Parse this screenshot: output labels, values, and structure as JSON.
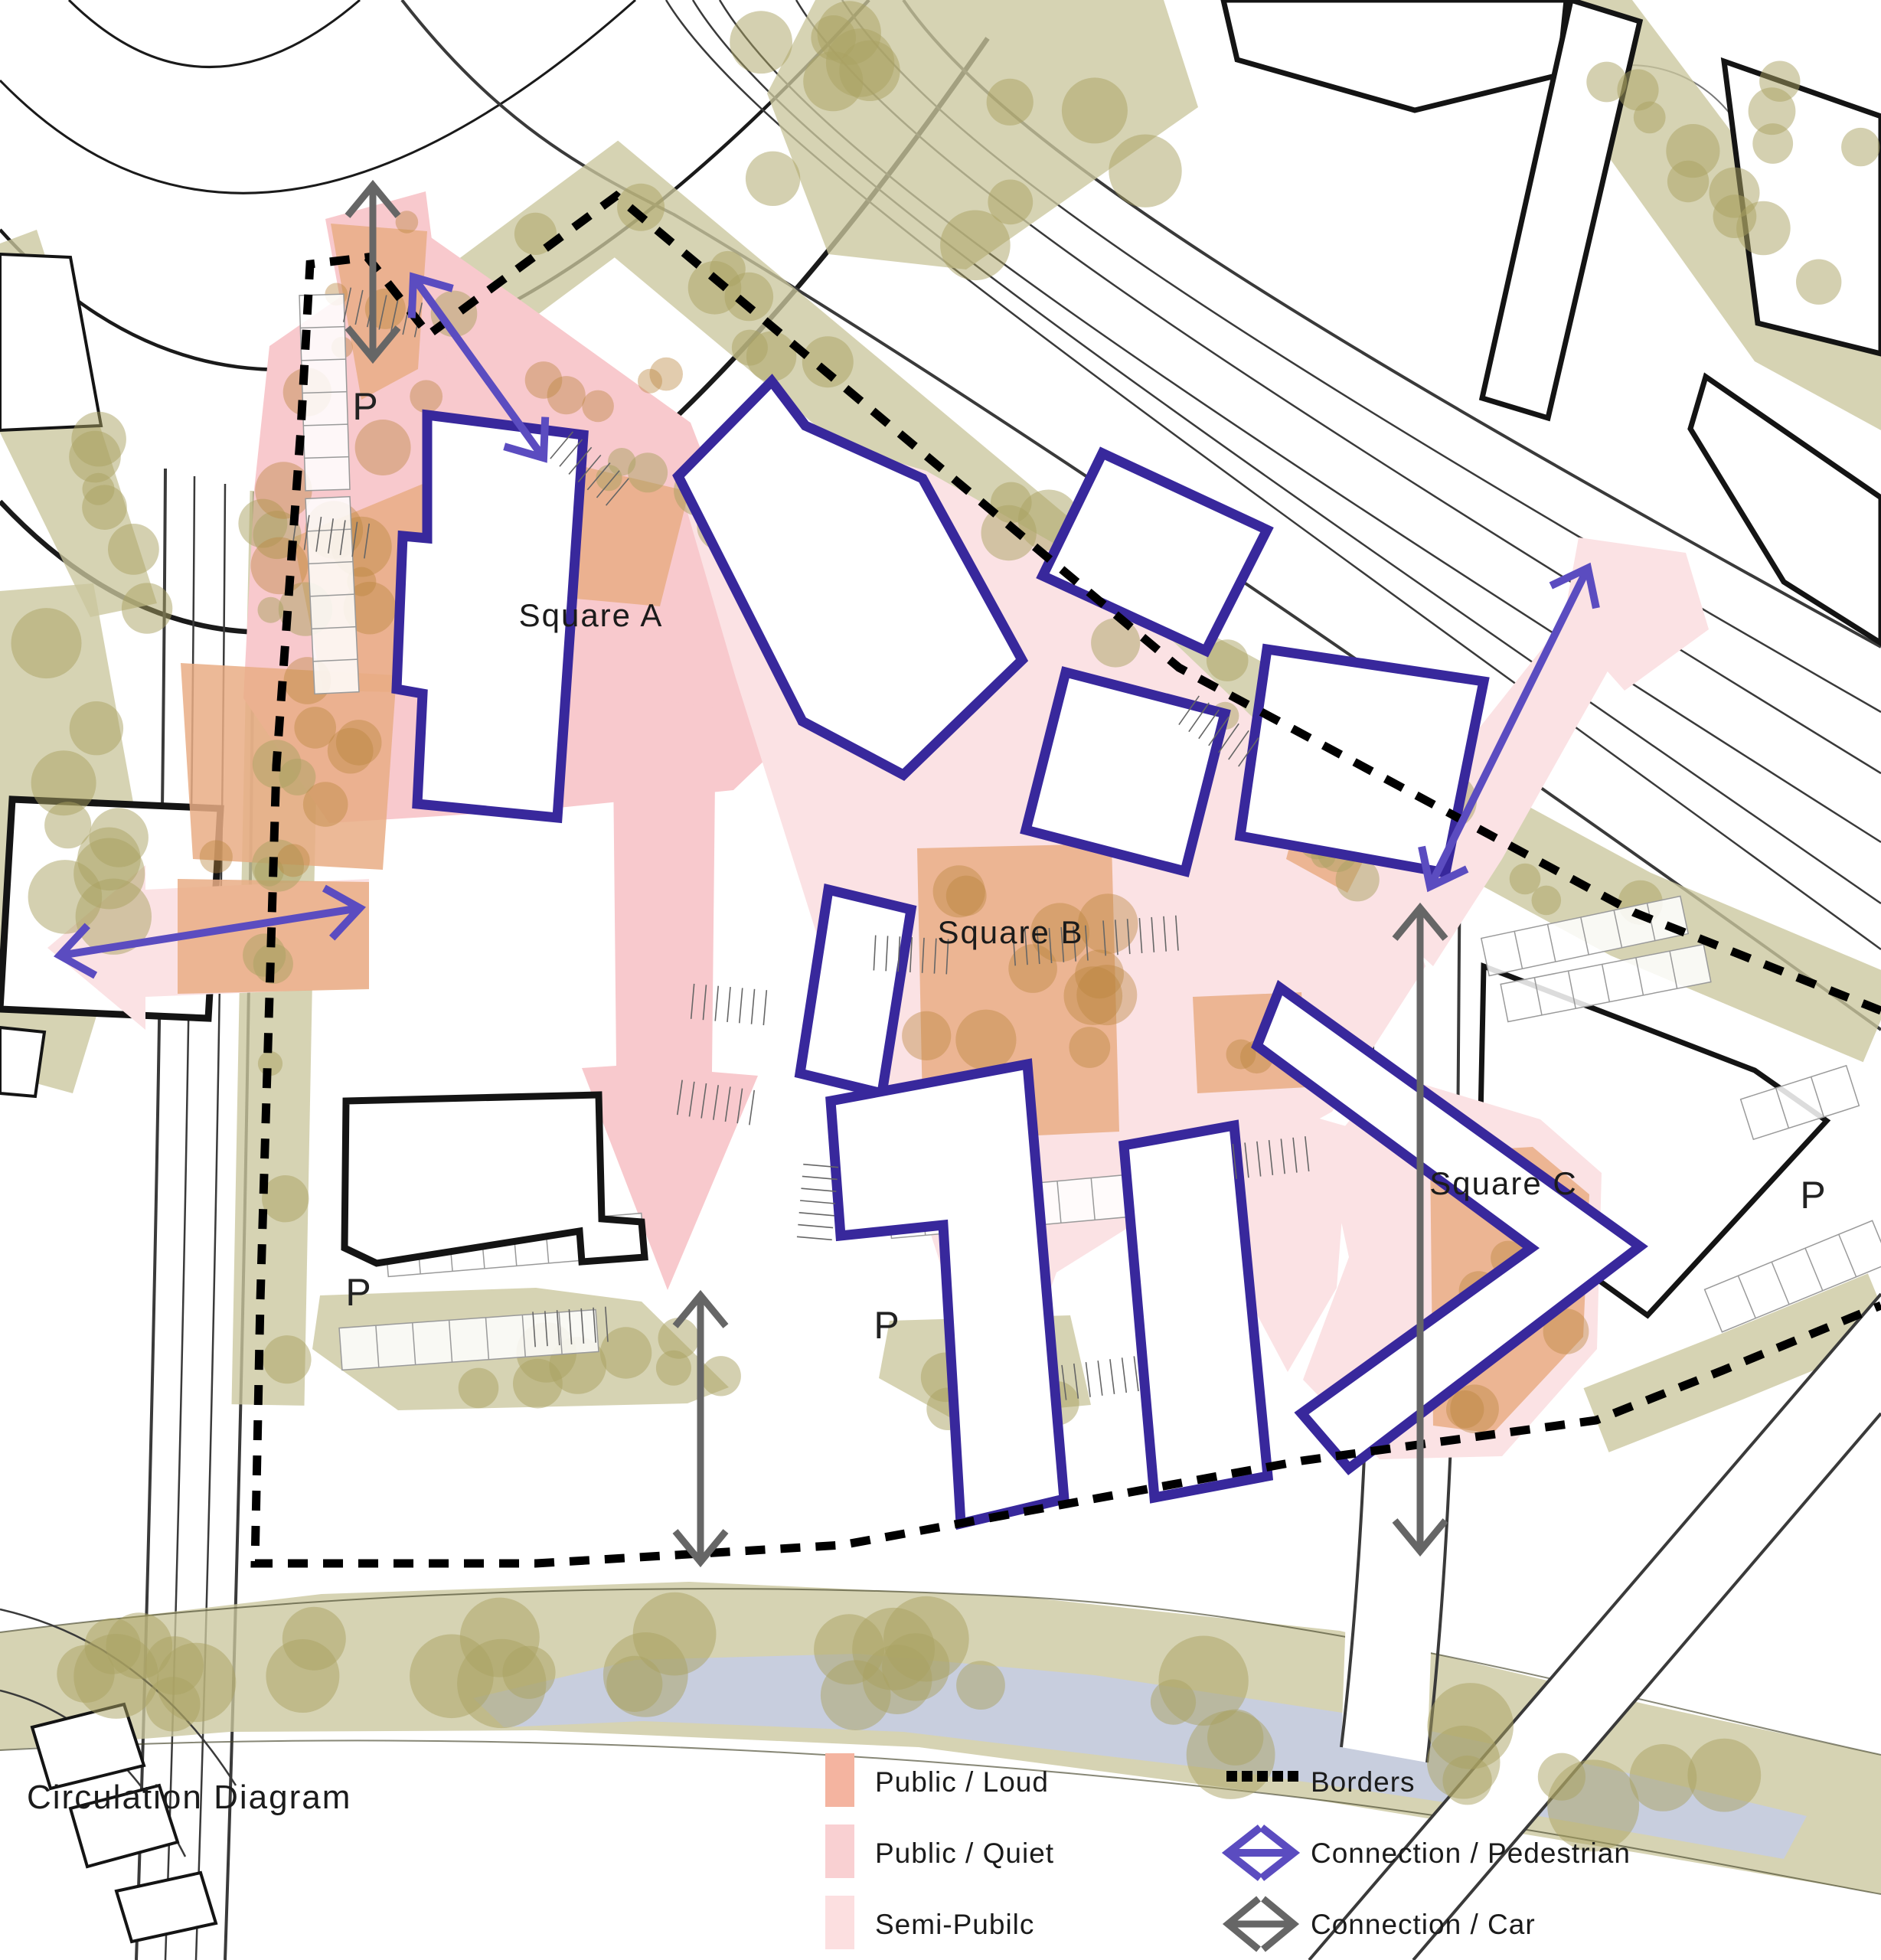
{
  "title": "Circulation Diagram",
  "map": {
    "labels": {
      "square_a": "Square A",
      "square_b": "Square B",
      "square_c": "Square C",
      "parking": "P"
    }
  },
  "legend": {
    "zones": [
      {
        "label": "Public / Loud",
        "color": "#f4b4a0"
      },
      {
        "label": "Public / Quiet",
        "color": "#f9d0d2"
      },
      {
        "label": "Semi-Pubilc",
        "color": "#fcdfe0"
      }
    ],
    "lines": [
      {
        "label": "Borders",
        "type": "dashed-line",
        "color": "#000000"
      },
      {
        "label": "Connection / Pedestrian",
        "type": "double-arrow",
        "color": "#5b4cc0"
      },
      {
        "label": "Connection / Car",
        "type": "double-arrow",
        "color": "#666666"
      }
    ]
  },
  "palette": {
    "building_outline": "#38289c",
    "pedestrian": "#5b4cc0",
    "car": "#666666",
    "border": "#000000",
    "zone_loud": "#e9ad85",
    "zone_quiet": "#f8c9cd",
    "zone_semi": "#fbe2e4",
    "green": "#cbc69e",
    "tree": "#a9a161",
    "tree_brown": "#b9853e",
    "water": "#c7cde2"
  }
}
